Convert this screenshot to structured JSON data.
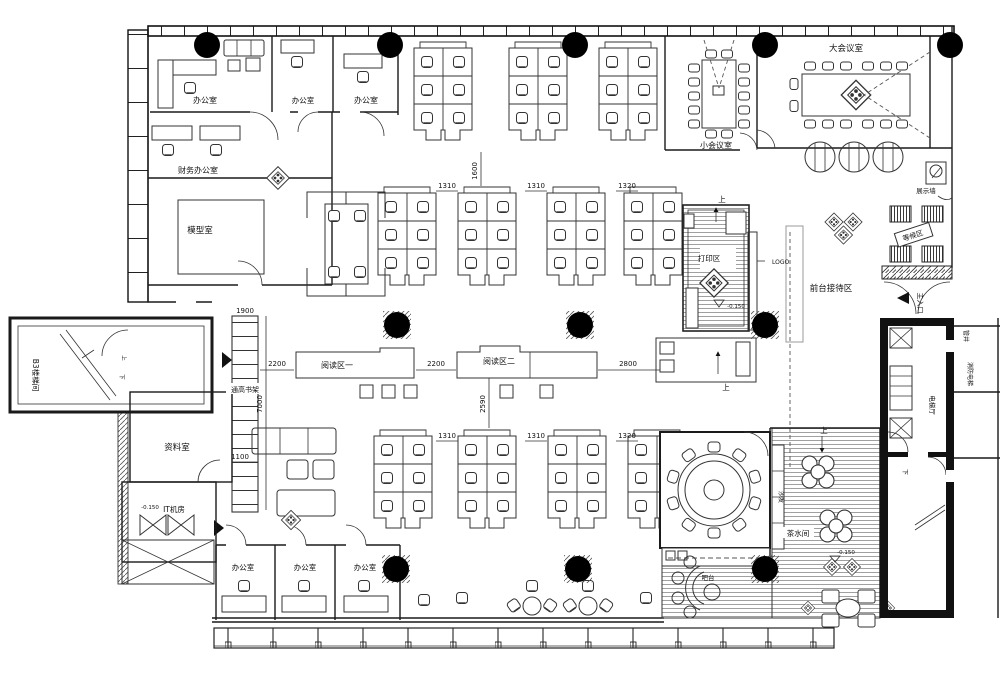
{
  "plan": {
    "rooms": {
      "top_offices": [
        "办公室",
        "办公室",
        "办公室"
      ],
      "finance_office": "财务办公室",
      "model_room": "模型室",
      "small_meeting": "小会议室",
      "big_meeting": "大会议室",
      "display_wall": "展示墙",
      "waiting_area": "等候区",
      "reception_area": "前台接待区",
      "print_area": "打印区",
      "logo_wall": "LOGO",
      "reading_area_1": "阅读区一",
      "reading_area_2": "阅读区二",
      "tall_bookshelf": "通高书架",
      "archive_room": "资料室",
      "it_room": "IT机房",
      "bottom_offices": [
        "办公室",
        "办公室",
        "办公室"
      ],
      "tea_room": "茶水间",
      "sofa": "沙发",
      "bar_counter": "吧台",
      "main_entrance": "主入口",
      "b3_stair": "B3楼梯间",
      "elevator_hall": "电梯厅",
      "fire_elevator": "消防电梯",
      "pipe_shaft": "管井"
    },
    "dimensions": {
      "h_top": [
        "1310",
        "1310",
        "1320"
      ],
      "v_1600": "1600",
      "h_reading": [
        "2200",
        "2200",
        "2800"
      ],
      "v_2590": "2590",
      "h_bottom": [
        "1310",
        "1310",
        "1320"
      ],
      "shelf_top": "1900",
      "shelf_height": "7000",
      "shelf_bottom": "1100"
    },
    "marks": {
      "up": "上",
      "down": "下",
      "level": "-0.150"
    }
  }
}
